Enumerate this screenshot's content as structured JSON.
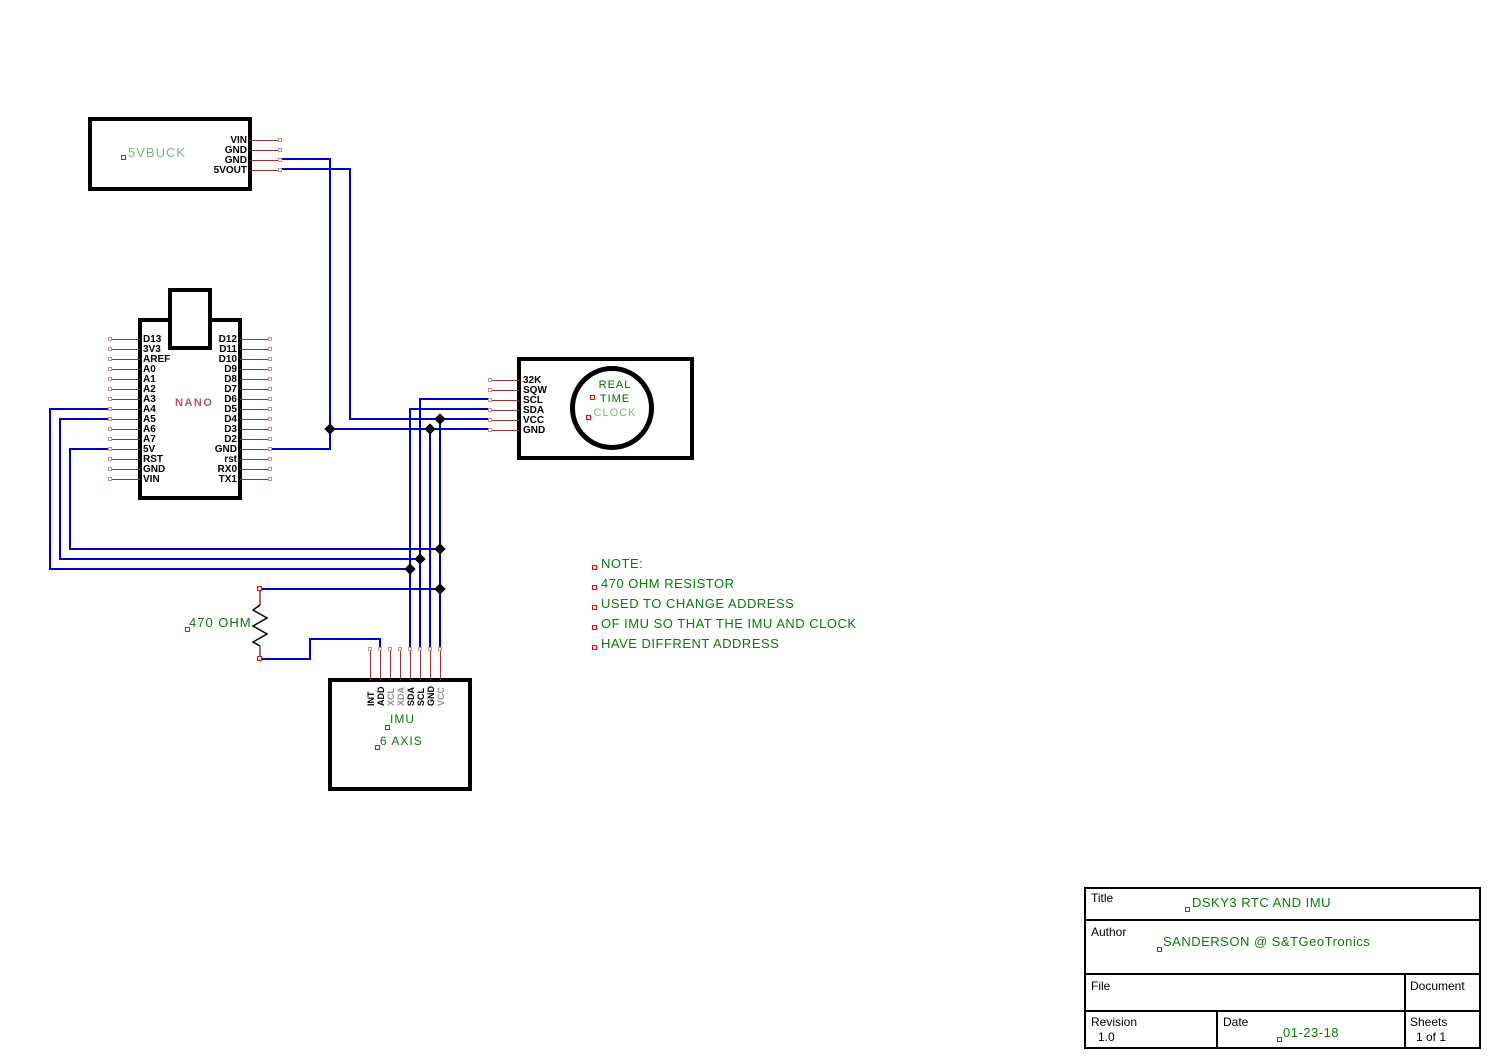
{
  "colors": {
    "wire": "#0000cc",
    "pin_stub": "#993333",
    "pin_end_marker": "#cc8f8f",
    "component_border": "#000000",
    "green_text": "#0a7a0a",
    "green_light": "#7db87d",
    "green_dark": "#056605",
    "nano_label": "#c05555",
    "gray_pin_label": "#909090",
    "anchor_marker": "#ff0000",
    "junction": "#000000"
  },
  "components": {
    "buck": {
      "label": "5VBUCK"
    },
    "nano": {
      "label": "NANO"
    },
    "rtc": {
      "label_line1": "REAL",
      "label_line2": "TIME",
      "label_line3": "CLOCK"
    },
    "imu": {
      "label_line1": "IMU",
      "label_line2": "6 AXIS"
    },
    "resistor": {
      "label": "470 OHM"
    }
  },
  "pin_groups": [
    {
      "group": "buck-pins",
      "orient": "h",
      "edge": 250,
      "end": 280,
      "label_x": 247,
      "align": "right",
      "items": [
        {
          "label": "VIN",
          "y": 140
        },
        {
          "label": "GND",
          "y": 150
        },
        {
          "label": "GND",
          "y": 160
        },
        {
          "label": "5VOUT",
          "y": 170
        }
      ]
    },
    {
      "group": "nano-left-pins",
      "orient": "h",
      "edge": 140,
      "end": 110,
      "label_x": 143,
      "align": "left",
      "items": [
        {
          "label": "D13",
          "y": 339
        },
        {
          "label": "3V3",
          "y": 349
        },
        {
          "label": "AREF",
          "y": 359
        },
        {
          "label": "A0",
          "y": 369
        },
        {
          "label": "A1",
          "y": 379
        },
        {
          "label": "A2",
          "y": 389
        },
        {
          "label": "A3",
          "y": 399
        },
        {
          "label": "A4",
          "y": 409
        },
        {
          "label": "A5",
          "y": 419
        },
        {
          "label": "A6",
          "y": 429
        },
        {
          "label": "A7",
          "y": 439
        },
        {
          "label": "5V",
          "y": 449
        },
        {
          "label": "RST",
          "y": 459
        },
        {
          "label": "GND",
          "y": 469
        },
        {
          "label": "VIN",
          "y": 479
        }
      ]
    },
    {
      "group": "nano-right-pins",
      "orient": "h",
      "edge": 240,
      "end": 270,
      "label_x": 237,
      "align": "right",
      "items": [
        {
          "label": "D12",
          "y": 339
        },
        {
          "label": "D11",
          "y": 349
        },
        {
          "label": "D10",
          "y": 359
        },
        {
          "label": "D9",
          "y": 369
        },
        {
          "label": "D8",
          "y": 379
        },
        {
          "label": "D7",
          "y": 389
        },
        {
          "label": "D6",
          "y": 399
        },
        {
          "label": "D5",
          "y": 409
        },
        {
          "label": "D4",
          "y": 419
        },
        {
          "label": "D3",
          "y": 429
        },
        {
          "label": "D2",
          "y": 439
        },
        {
          "label": "GND",
          "y": 449
        },
        {
          "label": "rst",
          "y": 459
        },
        {
          "label": "RX0",
          "y": 469
        },
        {
          "label": "TX1",
          "y": 479
        }
      ]
    },
    {
      "group": "rtc-pins",
      "orient": "h",
      "edge": 519,
      "end": 490,
      "label_x": 523,
      "align": "left",
      "items": [
        {
          "label": "32K",
          "y": 380
        },
        {
          "label": "SQW",
          "y": 390
        },
        {
          "label": "SCL",
          "y": 400
        },
        {
          "label": "SDA",
          "y": 410
        },
        {
          "label": "VCC",
          "y": 420
        },
        {
          "label": "GND",
          "y": 430
        }
      ]
    },
    {
      "group": "imu-pins",
      "orient": "v",
      "edge": 680,
      "end": 649,
      "label_y": 706,
      "items": [
        {
          "label": "INT",
          "x": 370
        },
        {
          "label": "ADD",
          "x": 380
        },
        {
          "label": "XCL",
          "x": 390,
          "gray": true
        },
        {
          "label": "XDA",
          "x": 400,
          "gray": true
        },
        {
          "label": "SDA",
          "x": 410
        },
        {
          "label": "SCL",
          "x": 420
        },
        {
          "label": "GND",
          "x": 430
        },
        {
          "label": "VCC",
          "x": 440,
          "gray": true
        }
      ]
    }
  ],
  "wires": [
    [
      280,
      159,
      330,
      159
    ],
    [
      330,
      159,
      330,
      449
    ],
    [
      270,
      449,
      330,
      449
    ],
    [
      330,
      429,
      490,
      429
    ],
    [
      280,
      169,
      350,
      169
    ],
    [
      350,
      169,
      350,
      419
    ],
    [
      350,
      419,
      490,
      419
    ],
    [
      440,
      419,
      440,
      649
    ],
    [
      70,
      449,
      110,
      449
    ],
    [
      70,
      449,
      70,
      549
    ],
    [
      70,
      549,
      440,
      549
    ],
    [
      260,
      589,
      440,
      589
    ],
    [
      50,
      409,
      110,
      409
    ],
    [
      50,
      409,
      50,
      569
    ],
    [
      50,
      569,
      410,
      569
    ],
    [
      410,
      409,
      410,
      649
    ],
    [
      410,
      409,
      490,
      409
    ],
    [
      60,
      419,
      110,
      419
    ],
    [
      60,
      419,
      60,
      559
    ],
    [
      60,
      559,
      420,
      559
    ],
    [
      420,
      399,
      420,
      649
    ],
    [
      420,
      399,
      490,
      399
    ],
    [
      430,
      429,
      430,
      649
    ],
    [
      260,
      659,
      310,
      659
    ],
    [
      310,
      639,
      310,
      659
    ],
    [
      310,
      639,
      380,
      639
    ],
    [
      380,
      639,
      380,
      649
    ]
  ],
  "junctions": [
    [
      330,
      429
    ],
    [
      430,
      429
    ],
    [
      440,
      419
    ],
    [
      440,
      549
    ],
    [
      420,
      559
    ],
    [
      410,
      569
    ],
    [
      440,
      589
    ]
  ],
  "anchor_markers": [
    [
      124,
      158
    ],
    [
      593,
      398
    ],
    [
      589,
      418
    ],
    [
      388,
      728
    ],
    [
      378,
      748
    ],
    [
      188,
      630
    ],
    [
      260,
      589
    ],
    [
      260,
      659
    ],
    [
      595,
      568
    ],
    [
      595,
      588
    ],
    [
      595,
      608
    ],
    [
      595,
      628
    ],
    [
      595,
      648
    ],
    [
      1188,
      910
    ],
    [
      1160,
      950
    ],
    [
      1280,
      1040
    ]
  ],
  "note": {
    "lines": [
      "NOTE:",
      "470 OHM RESISTOR",
      "USED TO CHANGE ADDRESS",
      "OF IMU SO THAT THE IMU AND CLOCK",
      "HAVE DIFFRENT ADDRESS"
    ]
  },
  "title_block": {
    "title_label": "Title",
    "title_value": "DSKY3 RTC AND IMU",
    "author_label": "Author",
    "author_value": "SANDERSON @ S&TGeoTronics",
    "file_label": "File",
    "document_label": "Document",
    "revision_label": "Revision",
    "revision_value": "1.0",
    "date_label": "Date",
    "date_value": "01-23-18",
    "sheets_label": "Sheets",
    "sheets_value": "1 of 1"
  }
}
